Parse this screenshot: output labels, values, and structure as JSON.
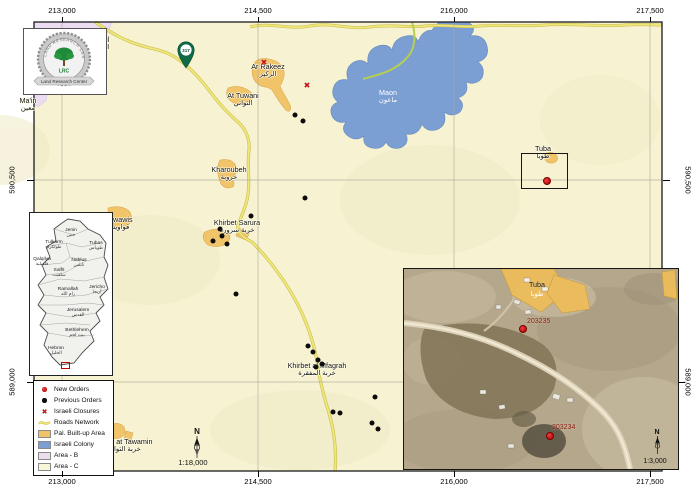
{
  "map": {
    "grid": {
      "x_ticks": [
        {
          "label": "213,000",
          "x": 62
        },
        {
          "label": "214,500",
          "x": 258
        },
        {
          "label": "216,000",
          "x": 454
        },
        {
          "label": "217,500",
          "x": 650
        }
      ],
      "y_ticks": [
        {
          "label": "590,500",
          "y": 180,
          "right_outside_inset": false
        },
        {
          "label": "589,000",
          "y": 382,
          "right_outside_inset": true
        }
      ]
    },
    "route_marker": {
      "number": "317"
    },
    "places": [
      {
        "en": "Ar Rakeez",
        "ar": "الركيز",
        "x": 268,
        "y": 63
      },
      {
        "en": "At Tuwani",
        "ar": "التواني",
        "x": 243,
        "y": 92
      },
      {
        "en": "Maon",
        "ar": "ماعون",
        "x": 388,
        "y": 89,
        "light": true
      },
      {
        "en": "Kharoubeh",
        "ar": "خروبة",
        "x": 229,
        "y": 166
      },
      {
        "en": "Khirbet Sarura",
        "ar": "خربة سرورة",
        "x": 237,
        "y": 219
      },
      {
        "en": "Khirbet al Mfagrah",
        "ar": "خربة المفقرة",
        "x": 317,
        "y": 362
      },
      {
        "en": "Tuba",
        "ar": "طوبا",
        "x": 543,
        "y": 145
      },
      {
        "en": "Ma'in",
        "ar": "معين",
        "x": 28,
        "y": 97
      },
      {
        "en": "Karmil",
        "ar": "الكرمل",
        "x": 99,
        "y": 36
      },
      {
        "en": "Qawawis",
        "ar": "قواويس",
        "x": 118,
        "y": 216
      },
      {
        "en": "Khirbet at Tawamin",
        "ar": "خربة التوامين",
        "x": 122,
        "y": 438
      }
    ],
    "previous_orders": [
      [
        295,
        115
      ],
      [
        303,
        121
      ],
      [
        305,
        198
      ],
      [
        251,
        216
      ],
      [
        220,
        229
      ],
      [
        222,
        236
      ],
      [
        213,
        241
      ],
      [
        227,
        244
      ],
      [
        236,
        294
      ],
      [
        308,
        346
      ],
      [
        313,
        352
      ],
      [
        318,
        360
      ],
      [
        322,
        364
      ],
      [
        316,
        367
      ],
      [
        375,
        397
      ],
      [
        333,
        412
      ],
      [
        340,
        413
      ],
      [
        372,
        423
      ],
      [
        378,
        429
      ]
    ],
    "closures": [
      [
        264,
        63
      ],
      [
        307,
        86
      ]
    ],
    "new_orders": [
      [
        547,
        181
      ]
    ],
    "north_label": "N",
    "scale_text": "1:18,000"
  },
  "legend": {
    "items": [
      {
        "symbol": "red-dot",
        "label": "New Orders"
      },
      {
        "symbol": "black-dot",
        "label": "Previous Orders"
      },
      {
        "symbol": "red-x",
        "label": "Israeli Closures"
      },
      {
        "symbol": "road",
        "label": "Roads Network"
      },
      {
        "symbol": "swatch",
        "color": "#F2C46A",
        "label": "Pal. Built-up Area"
      },
      {
        "symbol": "swatch",
        "color": "#7B9FD3",
        "label": "Israeli Colony"
      },
      {
        "symbol": "swatch",
        "color": "#EBDCF2",
        "label": "Area - B"
      },
      {
        "symbol": "swatch",
        "color": "#FAF6D8",
        "label": "Area - C"
      }
    ]
  },
  "logo": {
    "abbr": "LRC",
    "name": "Land Research Center",
    "ring": "LAND RESEARCH CENTER"
  },
  "overview_inset": {
    "districts": [
      {
        "en": "Jenin",
        "ar": "جنين",
        "x": 41,
        "y": 15
      },
      {
        "en": "Tulkarm",
        "ar": "طولكرم",
        "x": 24,
        "y": 27
      },
      {
        "en": "Tubas",
        "ar": "طوباس",
        "x": 66,
        "y": 28
      },
      {
        "en": "Qalqilya",
        "ar": "قلقيلية",
        "x": 12,
        "y": 44
      },
      {
        "en": "Nablus",
        "ar": "نابلس",
        "x": 49,
        "y": 45
      },
      {
        "en": "Salfit",
        "ar": "سلفيت",
        "x": 29,
        "y": 55
      },
      {
        "en": "Ramallah",
        "ar": "رام الله",
        "x": 38,
        "y": 74
      },
      {
        "en": "Jericho",
        "ar": "أريحا",
        "x": 67,
        "y": 72
      },
      {
        "en": "Jerusalem",
        "ar": "القدس",
        "x": 48,
        "y": 95
      },
      {
        "en": "Bethlehem",
        "ar": "بيت لحم",
        "x": 47,
        "y": 115
      },
      {
        "en": "Hebron",
        "ar": "الخليل",
        "x": 26,
        "y": 133
      }
    ]
  },
  "satellite_inset": {
    "labels": {
      "place_en": "Tuba",
      "place_ar": "طوبا",
      "code1": "203235",
      "code2": "203234",
      "north": "N",
      "scale": "1:3,000"
    },
    "points": [
      {
        "code": "code1",
        "x": 523,
        "y": 329,
        "lx": 527,
        "ly": 318
      },
      {
        "code": "code2",
        "x": 550,
        "y": 436,
        "lx": 552,
        "ly": 424
      }
    ]
  },
  "colors": {
    "new_order": "#C41414",
    "previous_order": "#0C0C0C",
    "closure": "#C41414",
    "road": "#EFE878",
    "pal_builtup": "#F2C46A",
    "israeli_colony": "#7B9FD3",
    "area_b": "#EBDCF2",
    "area_c": "#F7F3D2"
  }
}
